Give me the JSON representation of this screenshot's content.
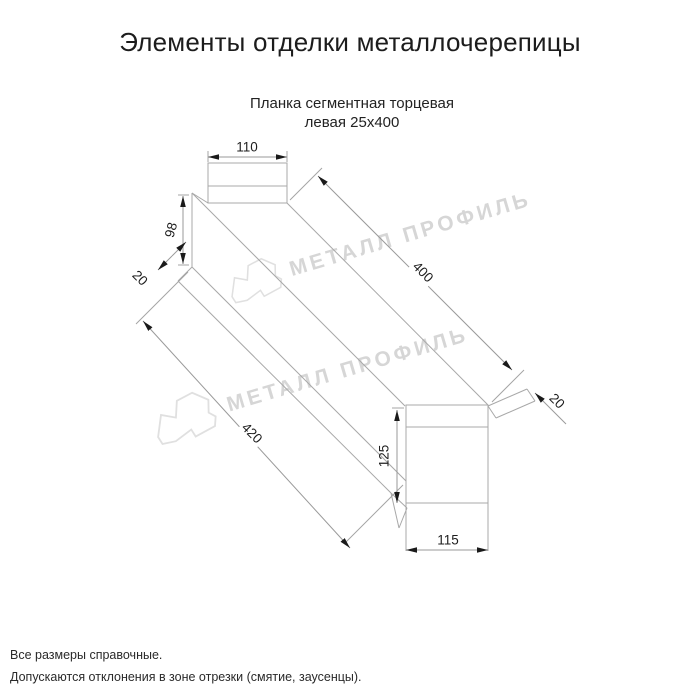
{
  "page": {
    "title": "Элементы отделки металлочерепицы"
  },
  "product": {
    "name_line1": "Планка сегментная торцевая",
    "name_line2": "левая 25х400"
  },
  "dimensions": {
    "top_width": "110",
    "near_height": "98",
    "near_hem": "20",
    "edge_top": "400",
    "edge_bottom": "420",
    "far_hem": "20",
    "far_height": "125",
    "far_width": "115"
  },
  "watermark": {
    "brand": "МЕТАЛЛ ПРОФИЛЬ"
  },
  "footnotes": {
    "line1": "Все размеры справочные.",
    "line2": "Допускаются отклонения в зоне отрезки (смятие, заусенцы)."
  },
  "colors": {
    "drawing_line": "#a8a8a8",
    "dimension_line": "#9a9a9a",
    "arrow": "#1a1a1a",
    "text": "#1c1c1c",
    "watermark": "#d6d6d6"
  }
}
